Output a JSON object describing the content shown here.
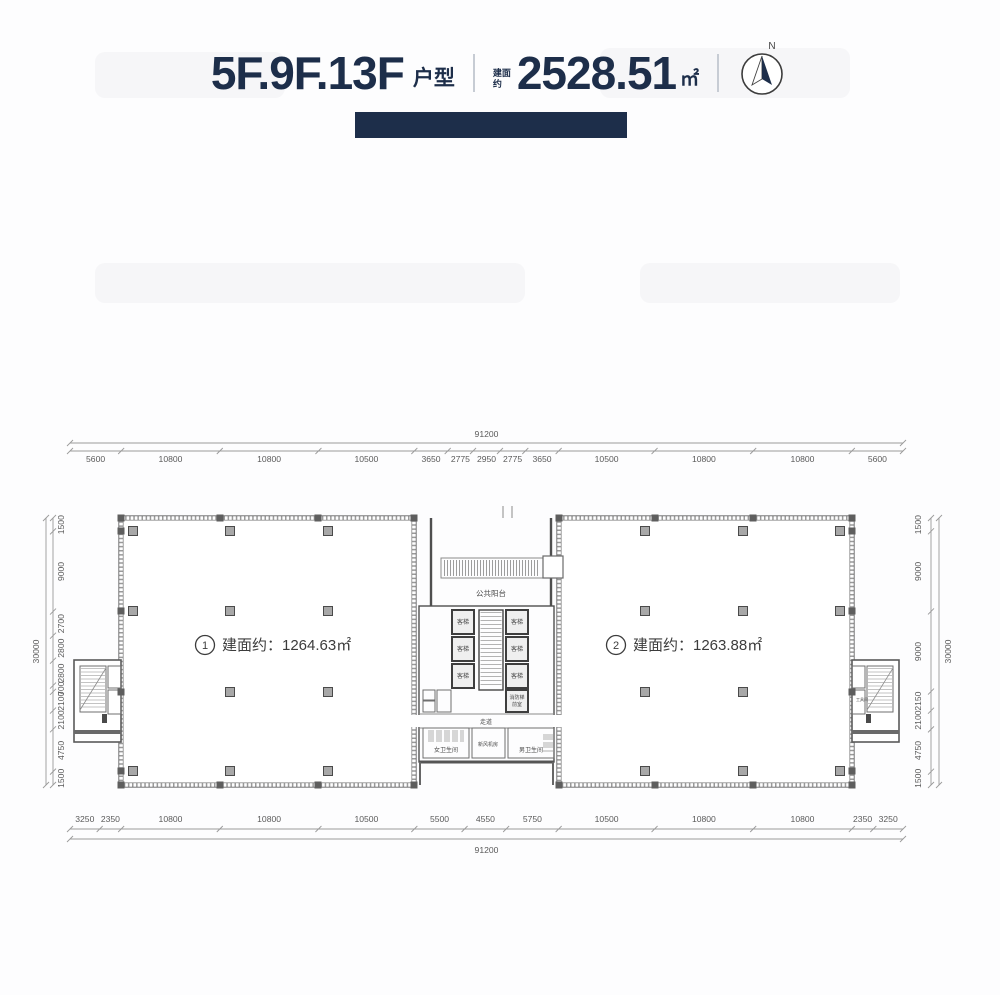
{
  "header": {
    "floors": "5F.9F.13F",
    "type_suffix": "户型",
    "area_prefix": "建面约",
    "area_value": "2528.51",
    "area_unit": "㎡",
    "compass_n": "N"
  },
  "plan": {
    "unit1": {
      "number": "1",
      "label": "建面约：1264.63㎡"
    },
    "unit2": {
      "number": "2",
      "label": "建面约：1263.88㎡"
    },
    "core": {
      "balcony": "公共阳台",
      "elevator": "客梯",
      "fire_elevator": {
        "line1": "消防梯",
        "line2": "前室"
      },
      "corridor": "走道",
      "womens_toilet": "女卫生间",
      "fresh_air_room": "新风机房",
      "mens_toilet": "男卫生间",
      "tool_room": "工具间"
    }
  },
  "dimensions": {
    "top": {
      "total": "91200",
      "segments": [
        "5600",
        "10800",
        "10800",
        "10500",
        "3650",
        "2775",
        "2950",
        "2775",
        "3650",
        "10500",
        "10800",
        "10800",
        "5600"
      ]
    },
    "bottom": {
      "total": "91200",
      "segments": [
        "3250",
        "2350",
        "10800",
        "10800",
        "10500",
        "5500",
        "4550",
        "5750",
        "10500",
        "10800",
        "10800",
        "2350",
        "3250"
      ]
    },
    "left": {
      "total": "30000",
      "segments": [
        "1500",
        "9000",
        "2700",
        "2800",
        "2800",
        "700",
        "2100",
        "2100",
        "4750",
        "1500"
      ]
    },
    "right": {
      "total": "30000",
      "segments": [
        "1500",
        "9000",
        "9000",
        "2150",
        "2100",
        "4750",
        "1500"
      ]
    }
  },
  "colors": {
    "accent": "#1d2e4a",
    "wall": "#5e5e5e",
    "dim_line": "#9a9a9a"
  }
}
